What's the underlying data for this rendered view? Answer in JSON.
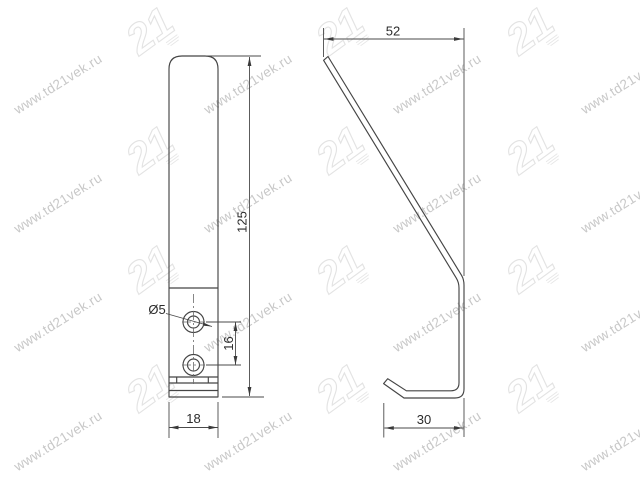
{
  "page": {
    "type": "technical-drawing",
    "background": "#ffffff"
  },
  "watermark": {
    "text": "www.td21vek.ru",
    "logo_text": "21"
  },
  "views": {
    "front": "front view of mounting plate with two holes",
    "side": "side profile view of hook"
  },
  "dimensions": {
    "overall_height": "125",
    "plate_width": "18",
    "hook_top_depth": "52",
    "hook_bottom_depth": "30",
    "hole_spacing": "16",
    "hole_diameter": "Ø5"
  },
  "colors": {
    "line": "#454545",
    "dim_text": "#2b2b2b",
    "watermark_text": "#c8c8c8",
    "watermark_logo": "#e3e3e3"
  }
}
